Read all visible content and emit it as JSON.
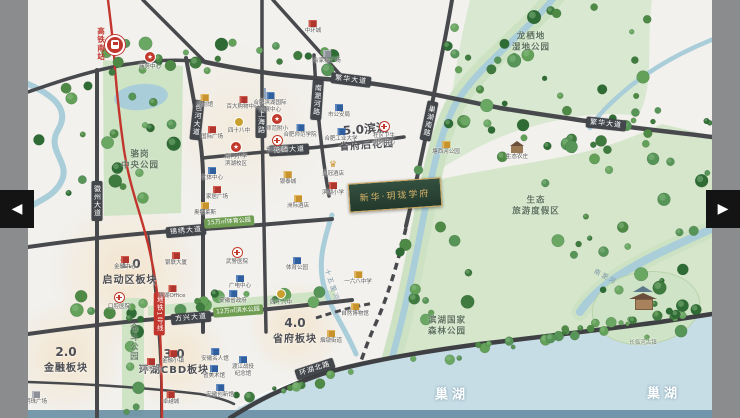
{
  "viewer": {
    "prev": "◀",
    "next": "▶"
  },
  "colors": {
    "metro_red": "#c2362e",
    "road_label_bg": "#43464b",
    "park_green": "#cfe3c5",
    "water_blue": "#a9cdd9",
    "project_gold": "#d7b469"
  },
  "map": {
    "area_labels": [
      {
        "num": "1.0",
        "name": "启动区板块",
        "x": 130,
        "y": 272
      },
      {
        "num": "2.0",
        "name": "金融板块",
        "x": 66,
        "y": 360
      },
      {
        "num": "3.0",
        "name": "环湖CBD板块",
        "x": 174,
        "y": 362
      },
      {
        "num": "4.0",
        "name": "省府板块",
        "x": 295,
        "y": 331
      },
      {
        "num": "5.0滨湖",
        "name": "省府后花园",
        "x": 366,
        "y": 137,
        "rot": -4
      }
    ],
    "road_labels": [
      {
        "t": "繁华大道",
        "x": 351,
        "y": 80,
        "rot": 7
      },
      {
        "t": "繁华大道",
        "x": 606,
        "y": 124,
        "rot": 6
      },
      {
        "t": "锦绣大道",
        "x": 186,
        "y": 231,
        "rot": -5
      },
      {
        "t": "方兴大道",
        "x": 191,
        "y": 318,
        "rot": -5
      },
      {
        "t": "花园大道",
        "x": 289,
        "y": 150,
        "rot": -3
      },
      {
        "t": "环湖北路",
        "x": 315,
        "y": 369,
        "rot": -18
      },
      {
        "t": "徽州大道",
        "x": 97,
        "y": 201,
        "v": 1
      },
      {
        "t": "包河大道",
        "x": 197,
        "y": 120,
        "v": 1,
        "rot": 6
      },
      {
        "t": "上海路",
        "x": 261,
        "y": 122,
        "v": 1
      },
      {
        "t": "南淝河路",
        "x": 317,
        "y": 100,
        "v": 1,
        "rot": 4
      },
      {
        "t": "巢湖南路",
        "x": 429,
        "y": 121,
        "v": 1,
        "rot": 12
      }
    ],
    "park_labels": [
      {
        "t": "骆岗\n中央公园",
        "x": 140,
        "y": 160
      },
      {
        "t": "龙栖地\n湿地公园",
        "x": 531,
        "y": 42
      },
      {
        "t": "生态\n旅游度假区",
        "x": 536,
        "y": 206
      },
      {
        "t": "滨湖国家\n森林公园",
        "x": 447,
        "y": 326
      },
      {
        "t": "金斗公园",
        "x": 133,
        "y": 342,
        "v": 1
      }
    ],
    "water_labels": [
      {
        "t": "巢湖",
        "x": 452,
        "y": 393,
        "big": 1
      },
      {
        "t": "巢湖",
        "x": 664,
        "y": 392,
        "big": 1
      },
      {
        "t": "十五里河",
        "x": 333,
        "y": 285,
        "rot": 72
      },
      {
        "t": "南淝河",
        "x": 606,
        "y": 276,
        "rot": 28
      }
    ],
    "green_badges": [
      {
        "t": "15万㎡体育公园",
        "x": 229,
        "y": 222
      },
      {
        "t": "12万㎡滨水公园",
        "x": 238,
        "y": 311
      }
    ],
    "metro": {
      "station_name": "高铁南站",
      "line_badge": "地铁1号线"
    },
    "project": {
      "name": "新华·玥珑学府",
      "x": 395,
      "y": 195,
      "rot": -4
    },
    "pois": [
      {
        "k": "red",
        "x": 313,
        "y": 12,
        "l": "中环城"
      },
      {
        "k": "gray",
        "x": 327,
        "y": 42,
        "l": "合家福广场"
      },
      {
        "k": "star",
        "x": 150,
        "y": 48,
        "l": "商务中心"
      },
      {
        "k": "gold",
        "x": 205,
        "y": 86,
        "l": "规划馆"
      },
      {
        "k": "red",
        "x": 243,
        "y": 88,
        "l": "百大购物中心"
      },
      {
        "k": "red",
        "x": 212,
        "y": 118,
        "l": "国际广场"
      },
      {
        "k": "goldc",
        "x": 239,
        "y": 112,
        "l": "四十八中"
      },
      {
        "k": "star",
        "x": 236,
        "y": 138,
        "l": "南门小学\n滨湖校区"
      },
      {
        "k": "blue",
        "x": 212,
        "y": 159,
        "l": "文体中心"
      },
      {
        "k": "red",
        "x": 217,
        "y": 178,
        "l": "家居广场"
      },
      {
        "k": "gold",
        "x": 205,
        "y": 194,
        "l": "奥特莱斯"
      },
      {
        "k": "flag",
        "x": 270,
        "y": 84,
        "l": "合肥滨湖国际\n会展中心"
      },
      {
        "k": "star",
        "x": 277,
        "y": 110,
        "l": "师范附小"
      },
      {
        "k": "blue",
        "x": 300,
        "y": 116,
        "l": "合肥师范学院"
      },
      {
        "k": "hosp",
        "x": 277,
        "y": 131,
        "l": "省立医院"
      },
      {
        "k": "blue",
        "x": 339,
        "y": 96,
        "l": "市公安局"
      },
      {
        "k": "blue",
        "x": 341,
        "y": 120,
        "l": "合肥工业大学"
      },
      {
        "k": "hosp",
        "x": 384,
        "y": 117,
        "l": "社区卫生\n服务中心"
      },
      {
        "k": "gold",
        "x": 288,
        "y": 163,
        "l": "银泰城"
      },
      {
        "k": "crown",
        "x": 333,
        "y": 155,
        "l": "皇冠酒店"
      },
      {
        "k": "red",
        "x": 333,
        "y": 174,
        "l": "滨湖小学"
      },
      {
        "k": "gold",
        "x": 298,
        "y": 187,
        "l": "洲际酒店"
      },
      {
        "k": "red",
        "x": 125,
        "y": 248,
        "l": "金融中心"
      },
      {
        "k": "red",
        "x": 176,
        "y": 244,
        "l": "银联大厦"
      },
      {
        "k": "hosp",
        "x": 119,
        "y": 288,
        "l": "口腔医院"
      },
      {
        "k": "red",
        "x": 172,
        "y": 277,
        "l": "滨湖Office"
      },
      {
        "k": "hosp",
        "x": 237,
        "y": 243,
        "l": "武警医院"
      },
      {
        "k": "blue",
        "x": 240,
        "y": 267,
        "l": "广电中心"
      },
      {
        "k": "blue",
        "x": 233,
        "y": 282,
        "l": "安徽省政府"
      },
      {
        "k": "blue",
        "x": 297,
        "y": 249,
        "l": "体育公园"
      },
      {
        "k": "goldc",
        "x": 281,
        "y": 284,
        "l": "四十六中"
      },
      {
        "k": "gold",
        "x": 358,
        "y": 263,
        "l": "一六八中学"
      },
      {
        "k": "gold",
        "x": 355,
        "y": 295,
        "l": "自然博物馆"
      },
      {
        "k": "gold",
        "x": 331,
        "y": 322,
        "l": "烟墩街道"
      },
      {
        "k": "red",
        "x": 173,
        "y": 342,
        "l": "金融小镇"
      },
      {
        "k": "red",
        "x": 151,
        "y": 350,
        "l": "双创中心"
      },
      {
        "k": "blue",
        "x": 215,
        "y": 340,
        "l": "安徽名人馆"
      },
      {
        "k": "blue",
        "x": 243,
        "y": 348,
        "l": "渡江战役\n纪念馆"
      },
      {
        "k": "blue",
        "x": 214,
        "y": 357,
        "l": "省美术馆"
      },
      {
        "k": "blue",
        "x": 220,
        "y": 376,
        "l": "安徽创新馆"
      },
      {
        "k": "red",
        "x": 171,
        "y": 383,
        "l": "卓越城"
      },
      {
        "k": "gray",
        "x": 36,
        "y": 383,
        "l": "明珠广场"
      },
      {
        "k": "gold",
        "x": 446,
        "y": 133,
        "l": "塘西河公园"
      },
      {
        "k": "house",
        "x": 517,
        "y": 138,
        "l": "生态农庄"
      },
      {
        "k": "temple",
        "x": 643,
        "y": 290,
        "l": "长临河古镇"
      }
    ]
  }
}
